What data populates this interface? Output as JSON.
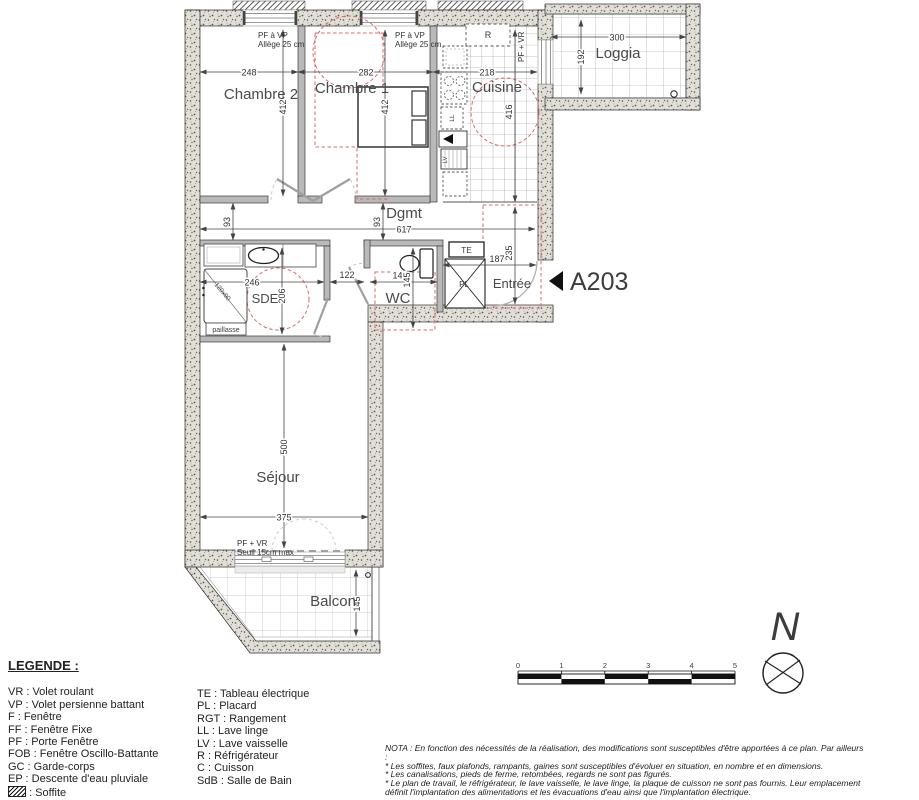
{
  "plan": {
    "unit": "A203",
    "rooms": {
      "chambre2": "Chambre 2",
      "chambre1": "Chambre 1",
      "cuisine": "Cuisine",
      "loggia": "Loggia",
      "dgmt": "Dgmt",
      "sde": "SDE",
      "wc": "WC",
      "entree": "Entrée",
      "sejour": "Séjour",
      "balcon": "Balcon"
    },
    "dims": {
      "ch2_w": "248",
      "ch1_w": "282",
      "cuisine_w": "218",
      "ch2_h": "412",
      "ch1_h": "412",
      "cuisine_h": "416",
      "loggia_w": "300",
      "loggia_d": "192",
      "dgmt_len": "617",
      "off_left": "93",
      "off_right": "93",
      "sde_w": "246",
      "sde_h": "206",
      "hall": "122",
      "wc_w": "141",
      "wc_h": "145",
      "entree_w": "187",
      "entree_h": "235",
      "sejour_h": "500",
      "sejour_w": "375",
      "balcon_d": "145",
      "shower": "120x90"
    },
    "openings": {
      "ch2_line1": "PF à VP",
      "ch2_line2": "Allège 25 cm",
      "ch1_line1": "PF à VP",
      "ch1_line2": "Allège 25 cm",
      "cuisine_door": "PF + VR",
      "sejour_line1": "PF + VR",
      "sejour_line2": "Seuil 15cm max"
    },
    "fixtures": {
      "te": "TE",
      "pl": "PL",
      "r": "R",
      "ll": "LL",
      "lv": "LV",
      "paillasse": "paillasse"
    },
    "north": "N",
    "scale_ticks": [
      "0",
      "1",
      "2",
      "3",
      "4",
      "5"
    ]
  },
  "legend": {
    "title": "LEGENDE :",
    "col1": [
      "VR : Volet roulant",
      "VP : Volet persienne battant",
      "F : Fenêtre",
      "FF : Fenêtre Fixe",
      "PF : Porte Fenêtre",
      "FOB : Fenêtre Oscillo-Battante",
      "GC : Garde-corps",
      "EP : Descente d'eau pluviale"
    ],
    "soffite": ": Soffite",
    "col2": [
      "TE : Tableau électrique",
      "PL : Placard",
      "RGT : Rangement",
      "LL : Lave linge",
      "LV : Lave vaisselle",
      "R : Réfrigérateur",
      "C : Cuisson",
      "SdB : Salle de Bain"
    ]
  },
  "nota": {
    "lines": [
      "NOTA : En fonction des nécessités de la réalisation, des modifications sont susceptibles d'être apportées à ce plan. Par ailleurs",
      ":",
      "* Les soffites, faux plafonds, rampants, gaines sont susceptibles d'évoluer en situation, en nombre et en dimensions.",
      "* Les canalisations, pieds de ferme, retombées, regards ne sont pas figurés.",
      "* Le plan de travail, le réfrigérateur, le lave vaisselle, le lave linge, la plaque de cuisson ne sont pas fournis. Leur emplacement",
      "définit l'implantation des alimentations et les évacuations d'eau ainsi que l'implantation électrique."
    ]
  }
}
